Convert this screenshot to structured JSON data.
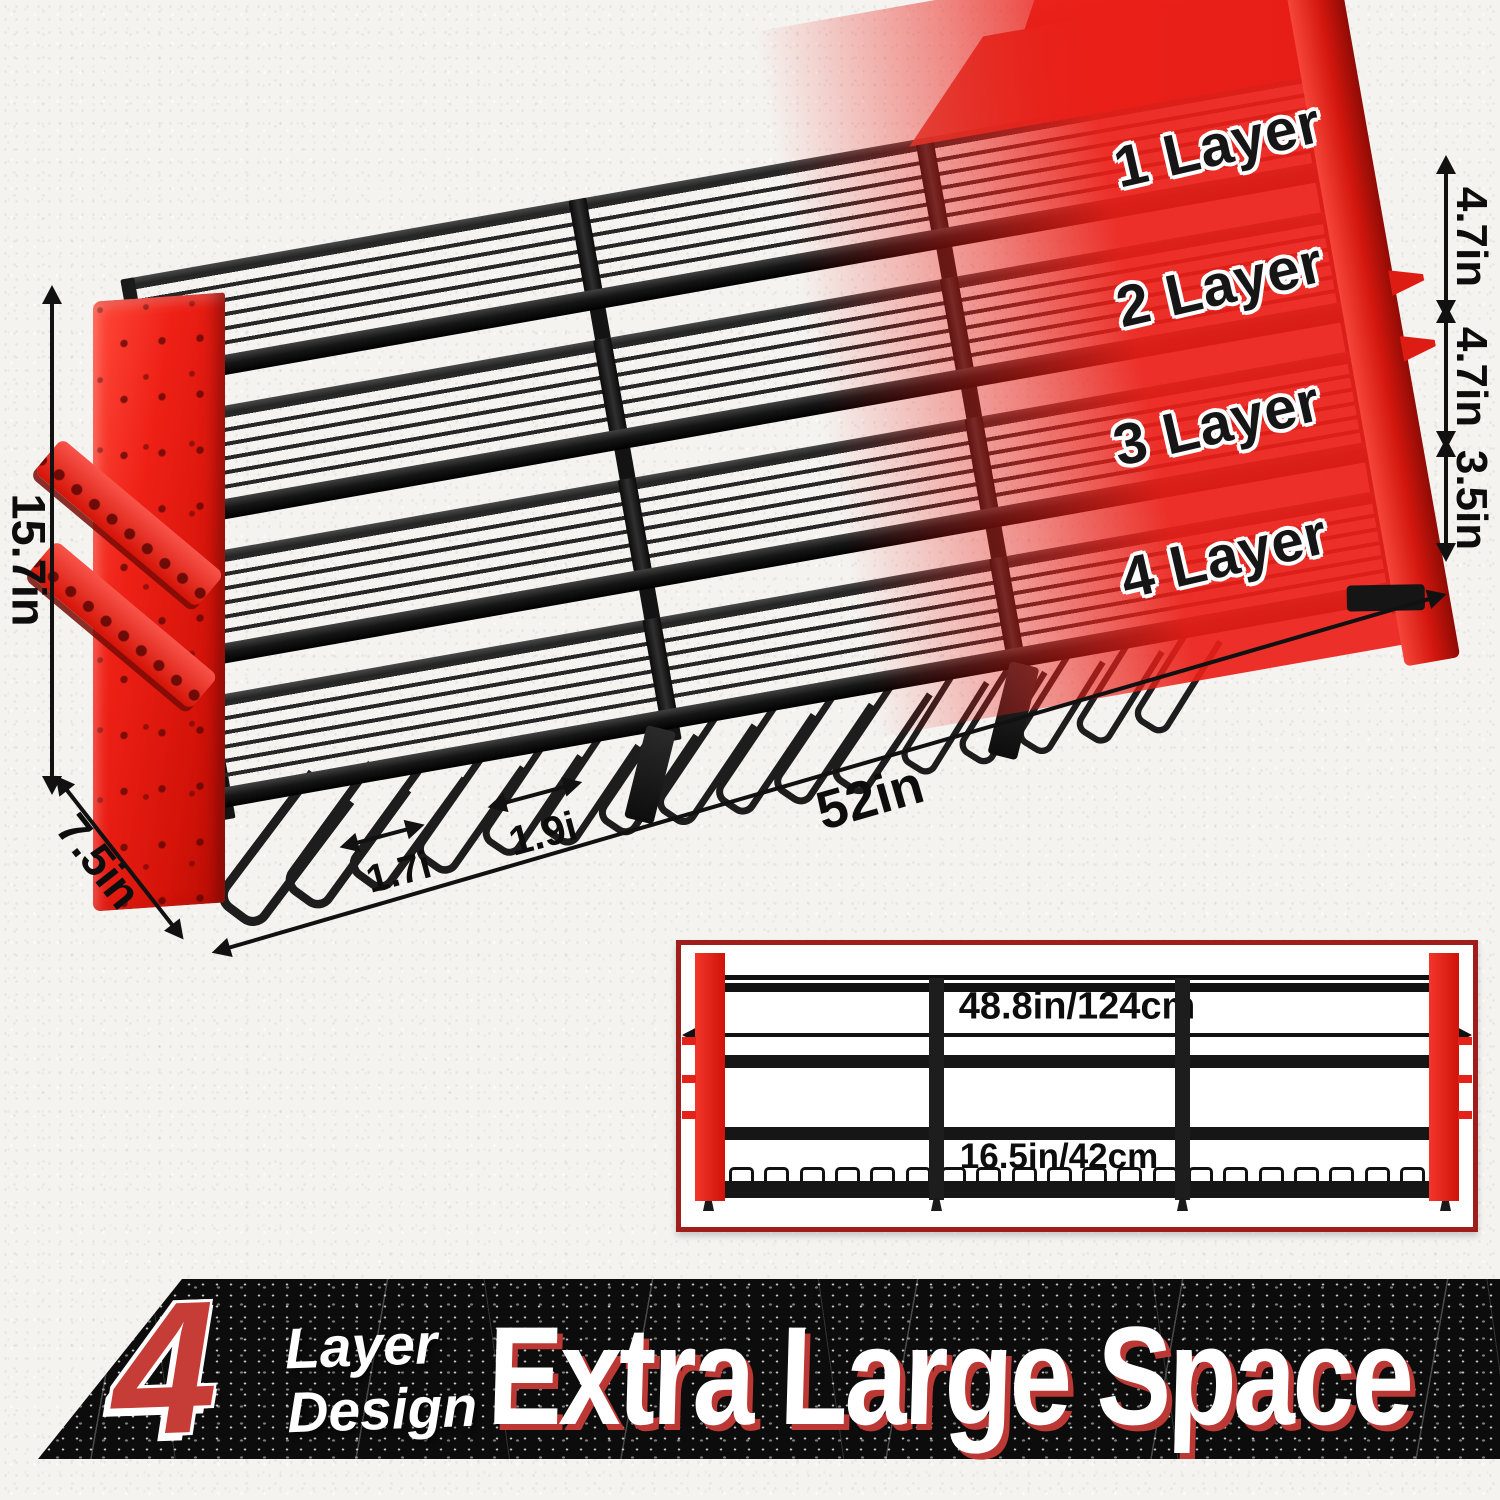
{
  "layers": {
    "l1": "1 Layer",
    "l2": "2 Layer",
    "l3": "3 Layer",
    "l4": "4 Layer"
  },
  "dims": {
    "height": "15.7in",
    "depth": "7.5in",
    "length": "52in",
    "slot_small": "1.7i",
    "slot_large": "1.9i",
    "gap1": "4.7in",
    "gap2": "4.7in",
    "gap3": "3.5in"
  },
  "inset": {
    "overall_width": "48.8in/124cm",
    "section_width": "16.5in/42cm"
  },
  "banner": {
    "big_number": "4",
    "subline1": "Layer",
    "subline2": "Design",
    "headline": "Extra Large Space"
  },
  "colors": {
    "accent_red": "#e81f17",
    "metal_black": "#1b1b1b",
    "banner_black": "#0c0c0c",
    "banner_red_shadow": "#bc3834",
    "dimension_text": "#111111"
  }
}
